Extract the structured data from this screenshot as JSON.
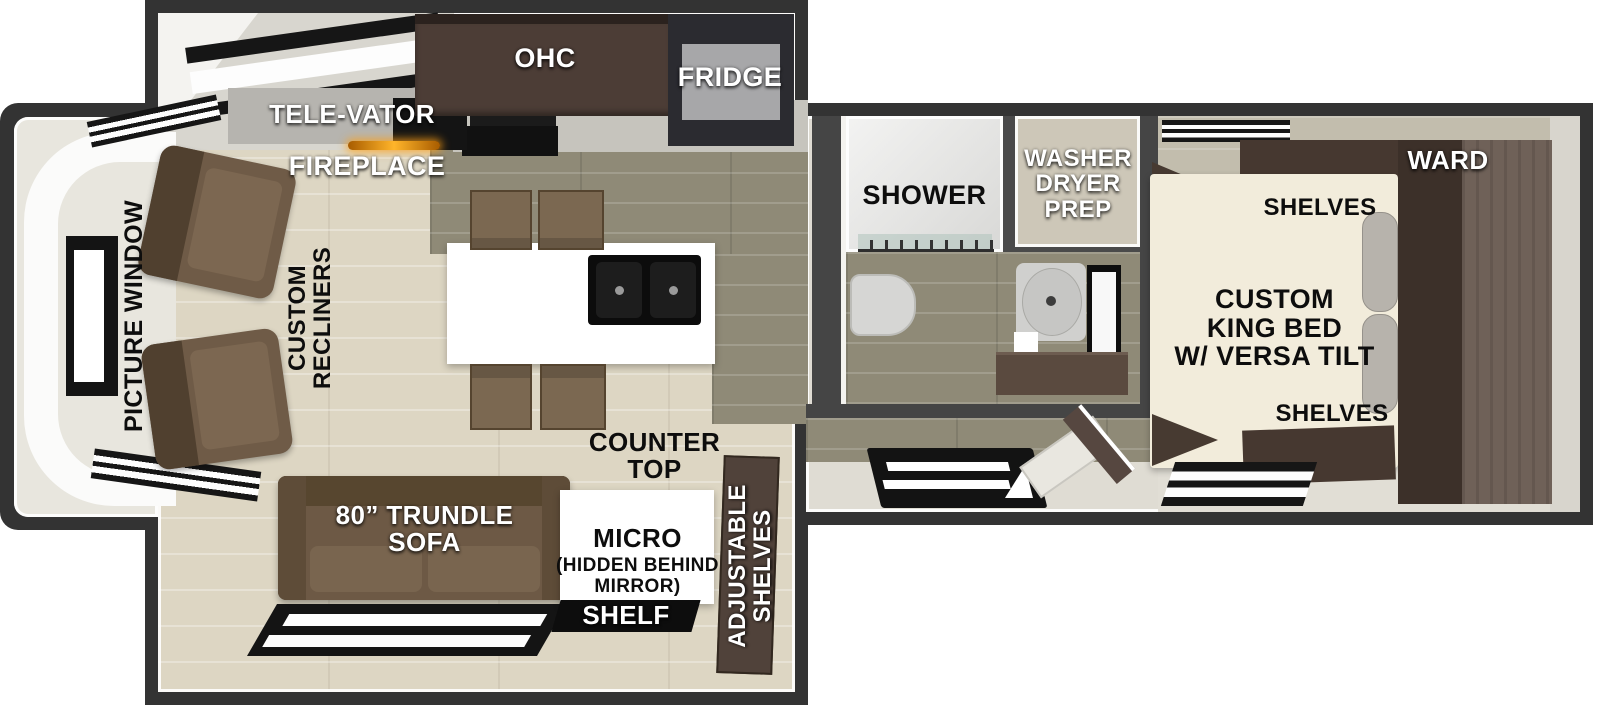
{
  "plan_title": "RV travel trailer floor plan",
  "front_cap": {
    "picture_window": "PICTURE WINDOW",
    "custom_recliners": "CUSTOM\nRECLINERS"
  },
  "kitchen": {
    "tele_vator": "TELE-VATOR",
    "fireplace": "FIREPLACE",
    "ohc": "OHC",
    "fridge": "FRIDGE",
    "counter_top": "COUNTER\nTOP"
  },
  "living": {
    "trundle_sofa": "80” TRUNDLE\nSOFA",
    "micro": "MICRO",
    "micro_sub": "(HIDDEN BEHIND\nMIRROR)",
    "shelf": "SHELF",
    "adjustable_shelves": "ADJUSTABLE\nSHELVES"
  },
  "bath": {
    "shower": "SHOWER",
    "washer_dryer_prep": "WASHER\nDRYER\nPREP"
  },
  "bedroom": {
    "ward": "WARD",
    "shelves_top": "SHELVES",
    "king_bed": "CUSTOM\nKING BED\nW/ VERSA TILT",
    "shelves_bottom": "SHELVES"
  },
  "colors": {
    "wall": "#333333",
    "floor_living": "#ddd6c3",
    "floor_kitchen_bath": "#8f8a77",
    "floor_bedroom": "#c2bdad",
    "furniture_brown": "#6e5a46",
    "cabinet_dark_brown": "#463831",
    "wardrobe_wood": "#6f6158",
    "island_counter": "#ffffff",
    "sink_black": "#0c0c0c",
    "fridge_gray": "#a7a7a9",
    "fireplace_glow": "#f09a12"
  }
}
